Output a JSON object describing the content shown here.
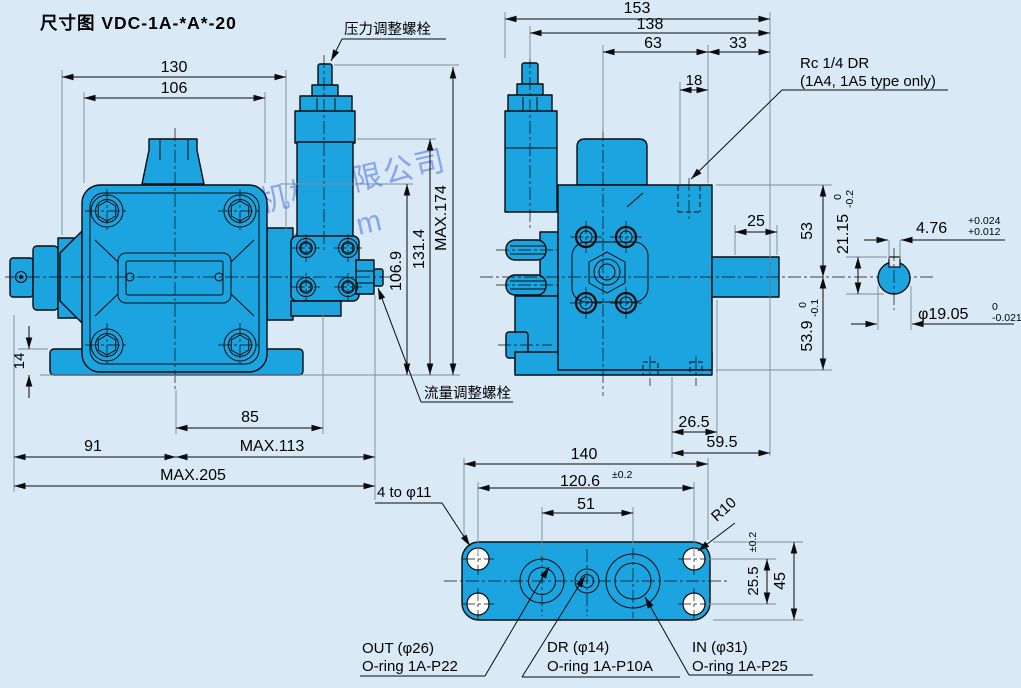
{
  "title": "尺寸图 VDC-1A-*A*-20",
  "colors": {
    "background": "#d9eaf6",
    "body_fill": "#1ca4e0",
    "watermark": "#345ce6"
  },
  "watermark": {
    "line1": "上海台拓液压机械有限公司",
    "line2": "http://www.tjyytw.com"
  },
  "callouts": {
    "pressure_bolt": "压力调整螺栓",
    "flow_bolt": "流量调整螺栓",
    "rc_dr_1": "Rc 1/4 DR",
    "rc_dr_2": "(1A4, 1A5 type only)",
    "four_holes": "4 to φ11",
    "r10": "R10",
    "out_line1": "OUT (φ26)",
    "out_line2": "O-ring 1A-P22",
    "dr_line1": "DR (φ14)",
    "dr_line2": "O-ring 1A-P10A",
    "in_line1": "IN (φ31)",
    "in_line2": "O-ring 1A-P25"
  },
  "front_view": {
    "width_130": "130",
    "width_106": "106",
    "height_max174": "MAX.174",
    "height_131_4": "131.4",
    "height_106_9": "106.9",
    "foot_14": "14",
    "base_85": "85",
    "base_max113": "MAX.113",
    "base_91": "91",
    "base_max205": "MAX.205"
  },
  "side_view": {
    "width_153": "153",
    "width_138": "138",
    "width_63": "63",
    "width_33": "33",
    "width_18": "18",
    "shaft_25": "25",
    "height_53": "53",
    "height_53_9": "53.9",
    "tol_53_9_upper": "0",
    "tol_53_9_lower": "-0.1",
    "base_26_5": "26.5",
    "base_59_5": "59.5"
  },
  "shaft_detail": {
    "key_height": "21.15",
    "tol_key_height_upper": "0",
    "tol_key_height_lower": "-0.2",
    "key_width": "4.76",
    "tol_key_width_upper": "+0.024",
    "tol_key_width_lower": "+0.012",
    "diameter": "φ19.05",
    "tol_diameter_upper": "0",
    "tol_diameter_lower": "-0.021"
  },
  "bottom_view": {
    "width_140": "140",
    "width_120_6": "120.6",
    "tol_120_6": "±0.2",
    "width_51": "51",
    "height_25_5": "25.5",
    "tol_25_5": "±0.2",
    "height_45": "45"
  }
}
